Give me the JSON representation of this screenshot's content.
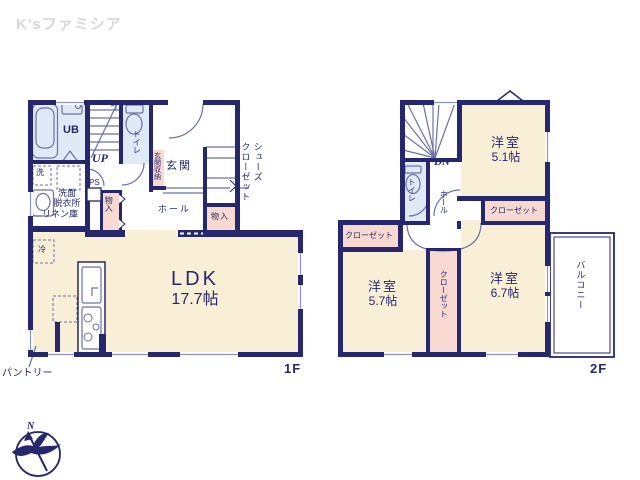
{
  "brand": {
    "logo_text": "K'sファミシア"
  },
  "colors": {
    "wall_navy": "#27276e",
    "room_beige": "#f9efd6",
    "closet_pink": "#f8d9d1",
    "bath_blue": "#dfeaf6",
    "fixture_line": "#6a71a8",
    "logo_gray": "#d7d7d7"
  },
  "compass": {
    "north_label": "N"
  },
  "floor1": {
    "floor_label": "1F",
    "ldk": {
      "name": "LDK",
      "size": "17.7帖"
    },
    "ub": "UB",
    "toilet": "トイレ",
    "entrance": "玄関",
    "entrance_storage": "玄関収納",
    "shoes_closet": [
      "シューズ",
      "クローゼット"
    ],
    "washroom_line1": "洗面",
    "washroom_line2": "脱衣所",
    "linen_closet": "リネン庫",
    "hall": "ホール",
    "storage_inner": "物入",
    "storage_right": "物入",
    "pantry": "パントリー",
    "stairs_up": "UP",
    "pipe_space": "PS",
    "washer": "洗",
    "fridge": "冷"
  },
  "floor2": {
    "floor_label": "2F",
    "stairs_down": "DN",
    "toilet": "トイレ",
    "hall": "ホール",
    "bedroom_a": {
      "name": "洋室",
      "size": "5.1帖"
    },
    "bedroom_b": {
      "name": "洋室",
      "size": "5.7帖"
    },
    "bedroom_c": {
      "name": "洋室",
      "size": "6.7帖"
    },
    "closet_a": "クローゼット",
    "closet_b": "クローゼット",
    "closet_c": "クローゼット",
    "balcony": "バルコニー"
  }
}
